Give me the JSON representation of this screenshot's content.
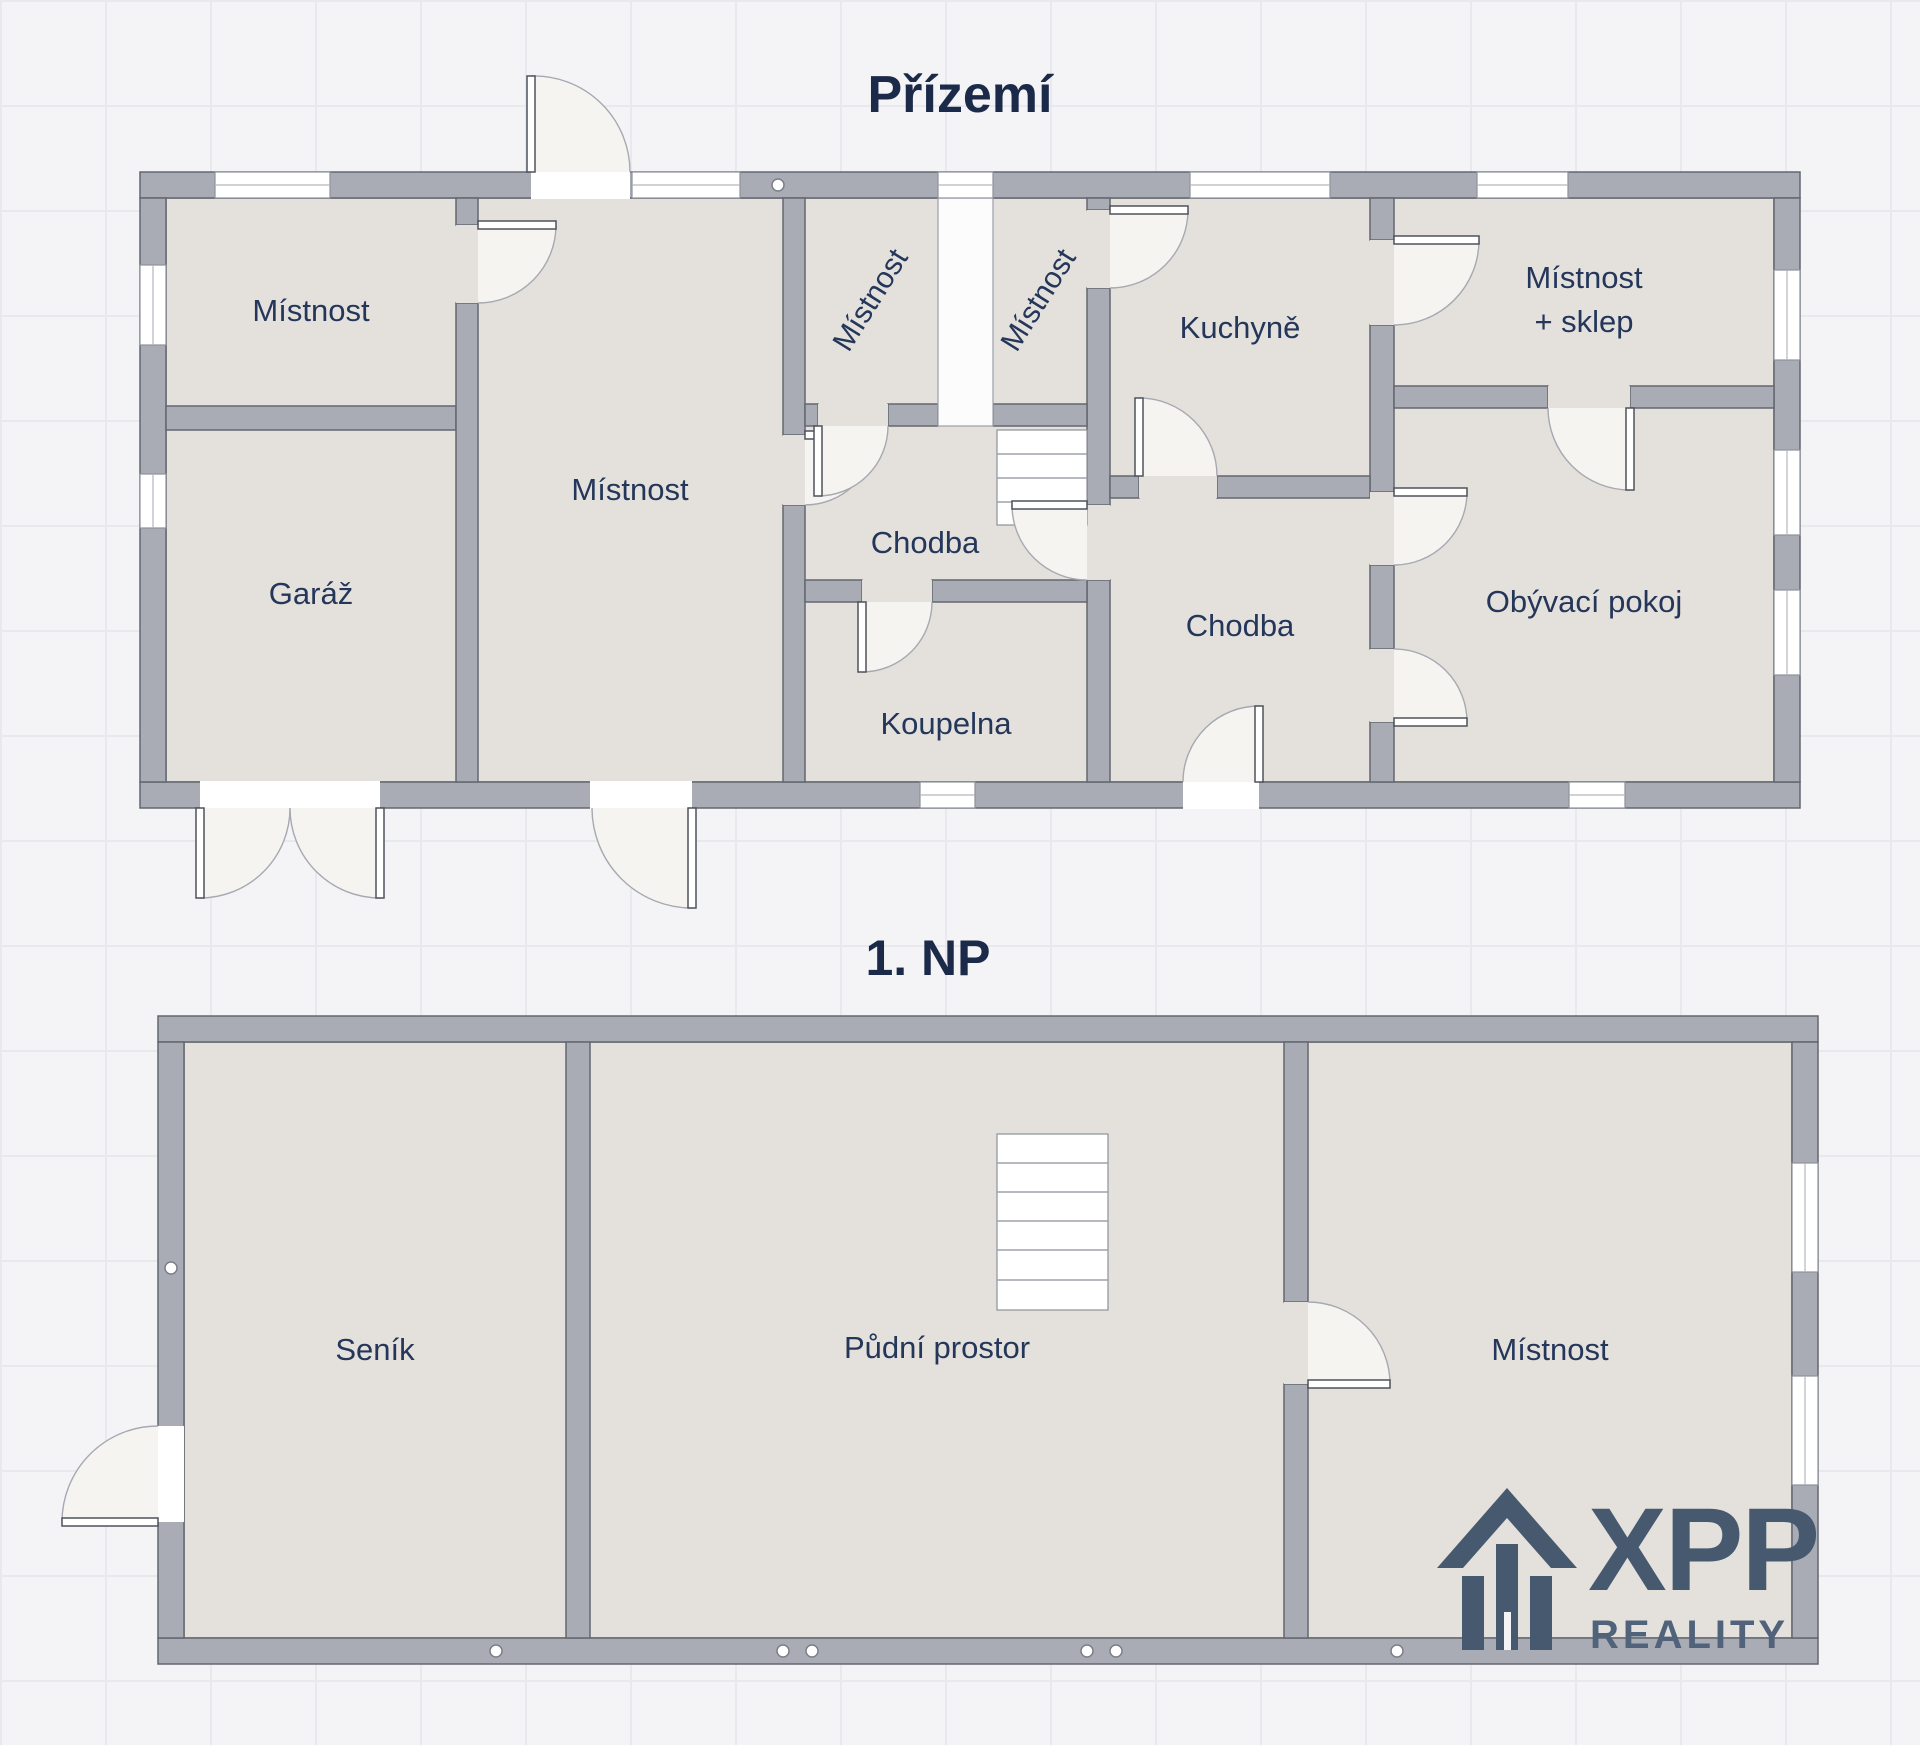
{
  "floors": [
    {
      "title": "Přízemí",
      "rooms": {
        "room_tl": "Místnost",
        "garage": "Garáž",
        "room_big": "Místnost",
        "room_small_1": "Místnost",
        "room_small_2": "Místnost",
        "kitchen": "Kuchyně",
        "room_cellar_1": "Místnost",
        "room_cellar_2": "+ sklep",
        "hall_1": "Chodba",
        "hall_2": "Chodba",
        "bathroom": "Koupelna",
        "living_room": "Obývací pokoj"
      }
    },
    {
      "title": "1. NP",
      "rooms": {
        "hayloft": "Seník",
        "attic": "Půdní prostor",
        "room": "Místnost"
      }
    }
  ],
  "logo": {
    "brand": "XPP",
    "sub": "REALITY"
  },
  "colors": {
    "bg": "#f4f4f7",
    "grid": "#e8e9ee",
    "wall": "#a9acb4",
    "walledge": "#63676f",
    "room": "#e4e1dc",
    "roomedge": "#6f737d",
    "text": "#24365a",
    "title": "#1b2a49",
    "disc": "#f6f4f0",
    "arc": "#a6a9b1",
    "leafedge": "#4e525b",
    "brand": "#47596f",
    "brand2": "#51627b"
  }
}
